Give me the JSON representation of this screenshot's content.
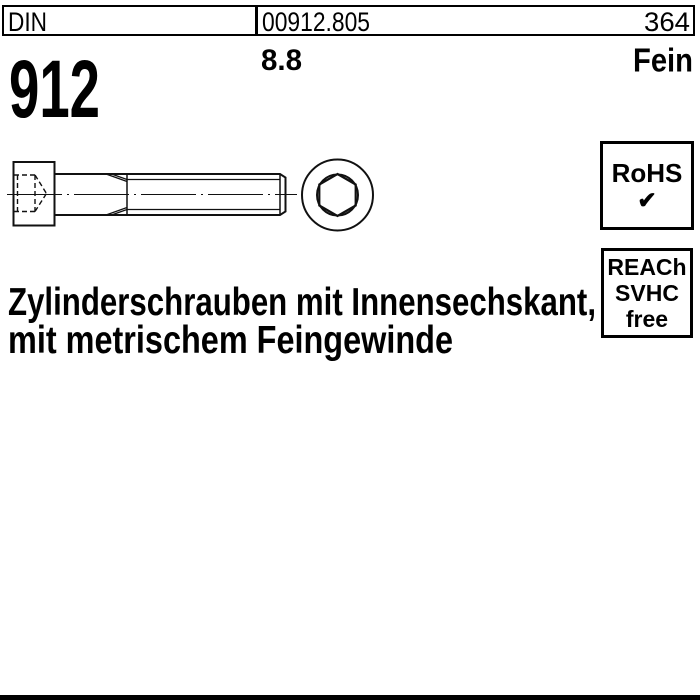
{
  "meta": {
    "ink_color": "#000000",
    "paper_color": "#ffffff"
  },
  "header": {
    "standard_label": "DIN",
    "standard_number": "912",
    "article_code": "00912.805",
    "page_number": "364",
    "strength_class": "8.8",
    "thread_variant": "Fein"
  },
  "title": {
    "line1": "Zylinderschrauben mit Innensechskant,",
    "line2": "mit metrischem Feingewinde"
  },
  "badges": {
    "rohs": {
      "label": "RoHS",
      "check_icon": "✔"
    },
    "reach": {
      "line1": "REACh",
      "line2": "SVHC",
      "line3": "free"
    }
  },
  "drawing": {
    "subject": "Zylinderschraube mit Innensechskant",
    "views": [
      "side-view",
      "front-view-hex-socket"
    ]
  }
}
